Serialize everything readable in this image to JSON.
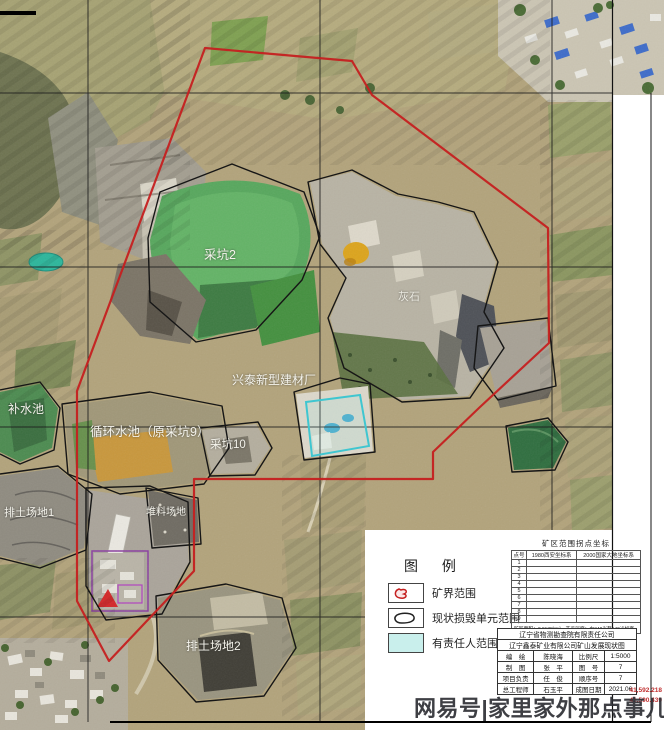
{
  "map": {
    "labels": [
      {
        "text": "采坑2"
      },
      {
        "text": "灰石"
      },
      {
        "text": "兴泰新型建材厂"
      },
      {
        "text": "补水池"
      },
      {
        "text": "循环水池（原采坑9）"
      },
      {
        "text": "采坑10"
      },
      {
        "text": "排土场地1"
      },
      {
        "text": "堆料场地"
      },
      {
        "text": "排土场地2"
      }
    ],
    "corner_coords": {
      "line1": "41,592.218",
      "line2": "41,590.439"
    }
  },
  "legend": {
    "title": "图  例",
    "items": [
      {
        "label": "矿界范围"
      },
      {
        "label": "现状损毁单元范围"
      },
      {
        "label": "有责任人范围"
      }
    ]
  },
  "coord_table": {
    "title": "矿区范围拐点坐标",
    "point_col": "点号",
    "sys1": "1980西安坐标系",
    "sys2": "2000国家大地坐标系",
    "points": [
      "1",
      "2",
      "3",
      "4",
      "5",
      "6",
      "7",
      "8",
      "9"
    ],
    "note": "矿区面积：0.9138km²　开采深度：由240米至140米标高"
  },
  "title_block": {
    "org": "辽宁省物测勘查院有限责任公司",
    "map_title": "辽宁鑫泰矿业有限公司矿山发展现状图",
    "rows": [
      {
        "k1": "编　绘",
        "v1": "陈晓海",
        "k2": "比例尺",
        "v2": "1:5000"
      },
      {
        "k1": "制　图",
        "v1": "张　平",
        "k2": "图　号",
        "v2": "7"
      },
      {
        "k1": "项目负责",
        "v1": "任　俊",
        "k2": "顺序号",
        "v2": "7"
      },
      {
        "k1": "总工程师",
        "v1": "石玉平",
        "k2": "成图日期",
        "v2": "2021.06"
      }
    ]
  },
  "watermark": "网易号|家里家外那点事儿",
  "colors": {
    "boundary_red": "#c52020",
    "unit_black": "#161616",
    "responsible_cyan": "#3fc6d0",
    "pond_green": "#57a75d",
    "highlight_yellow": "#dca41c"
  }
}
